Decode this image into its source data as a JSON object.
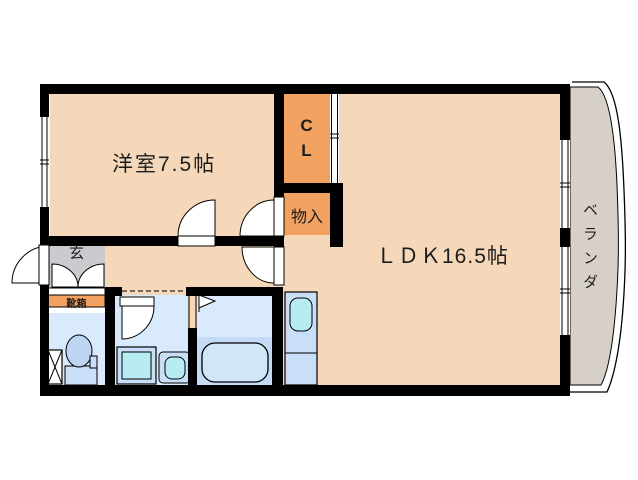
{
  "floorplan": {
    "type": "apartment-madori",
    "rooms": {
      "western_room": {
        "label": "洋室7.5帖",
        "size_jo": 7.5
      },
      "ldk": {
        "label": "ＬＤＫ16.5帖",
        "size_jo": 16.5
      },
      "closet": {
        "label": "CL"
      },
      "storage": {
        "label": "物入"
      },
      "entrance": {
        "label": "玄"
      },
      "shoe_box": {
        "label": "靴箱"
      },
      "balcony": {
        "label": "ベランダ"
      }
    },
    "fixtures": [
      "toilet",
      "washing-machine",
      "wash-basin",
      "bathtub",
      "kitchen-sink",
      "laundry-pan"
    ],
    "colors": {
      "floor_beige": "#f5d8ba",
      "closet_orange": "#f2a260",
      "entrance_gray": "#cbcbcf",
      "balcony_gray": "#d7d0c8",
      "wet_room_blue": "#d9eafc",
      "bath_lower_blue": "#c5daf4",
      "fixture_blue": "#c9def7",
      "sink_cyan": "#b7ecf2",
      "wall_black": "#000000"
    }
  }
}
